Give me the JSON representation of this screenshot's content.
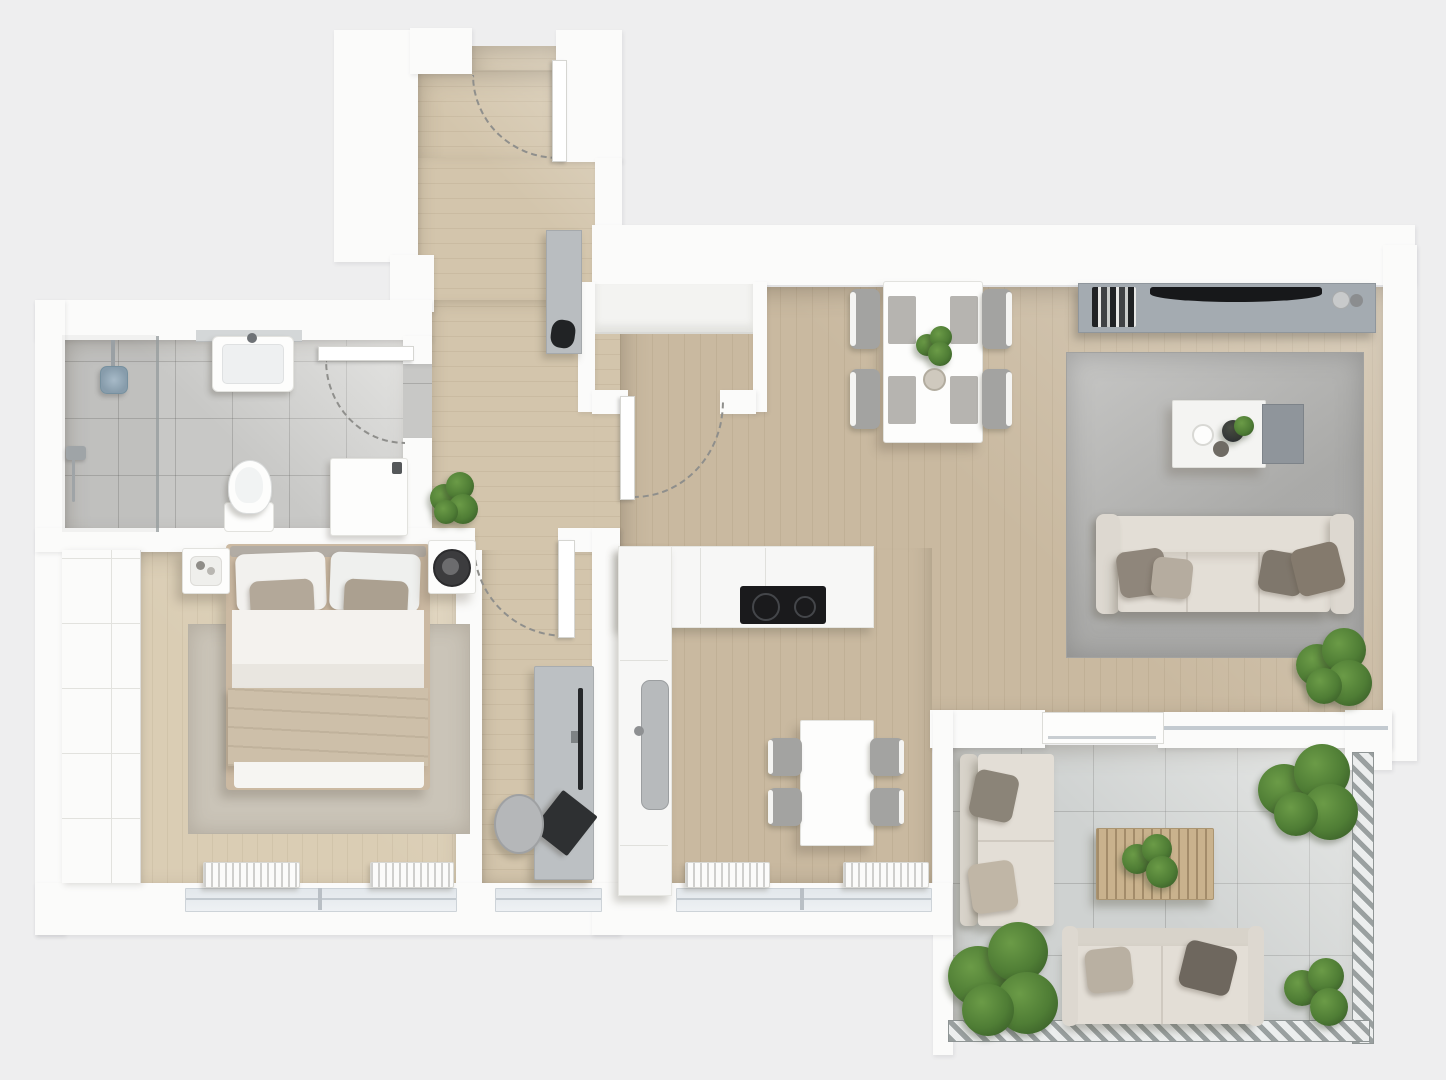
{
  "meta": {
    "title": "3D top-down floor plan of a one-bedroom apartment with balcony",
    "view": "top-down 3d render",
    "visible_text": ""
  },
  "palette": {
    "bg": "#eeeeef",
    "wall": "#fbfbfa",
    "wood-hall": "#d3c5ac",
    "wood-living": "#c9b9a0",
    "wood-bedroom": "#dacdb4",
    "tile-bath": "#c8c8c6",
    "tile-balcony": "#cfd2d1",
    "rug-living": "#b4b4b2",
    "rug-bedroom": "#cac4b8",
    "sofa": "#e3ded6",
    "console": "#a4abb1",
    "tv": "#17181a",
    "counter": "#f7f7f6",
    "appliance": "#1a1a1c",
    "chair": "#a3a3a1",
    "plant-dark": "#3b6029",
    "plant-mid": "#4f7d35",
    "plant-light": "#6b9b47",
    "outdoor-wood": "#c9b28d",
    "arc": "#8f8f8c",
    "sink-gray": "#b7babc",
    "desk-gray": "#bcc0c3",
    "blanket": "#cdbfa9",
    "pillow-taupe": "#b3a899",
    "cushion-dark": "#847a6d",
    "railing-dark": "#9aa0a0",
    "railing-light": "#eceeee"
  },
  "rooms": [
    {
      "name": "entry-hall",
      "floor": "wood",
      "items": [
        "front-door with swing arc",
        "gray sideboard with dark decor"
      ]
    },
    {
      "name": "hall-closet",
      "floor": "wood",
      "items": [
        "recessed wardrobe shelf",
        "closet door with swing arc"
      ]
    },
    {
      "name": "hallway",
      "floor": "wood",
      "items": [
        "potted plant",
        "desk",
        "monitor",
        "laptop",
        "stool",
        "door to bedroom nook"
      ]
    },
    {
      "name": "bathroom",
      "floor": "gray tile",
      "items": [
        "walk-in shower with glass screen",
        "shower head",
        "wall faucet",
        "washbasin",
        "toilet",
        "washer cabinet",
        "door with swing arc"
      ]
    },
    {
      "name": "bedroom",
      "floor": "wood",
      "items": [
        "double bed with pillows and beige blanket",
        "area rug",
        "left nightstand with tray",
        "right nightstand with dark round tray",
        "tall wardrobe",
        "two radiators",
        "window band"
      ]
    },
    {
      "name": "kitchen",
      "floor": "wood",
      "items": [
        "L-shaped counter",
        "black cooktop",
        "gray sink",
        "table for four",
        "four gray chairs",
        "two radiators",
        "window band"
      ]
    },
    {
      "name": "living-room",
      "floor": "wood",
      "items": [
        "media sideboard",
        "flat tv",
        "books",
        "decor objects",
        "dining table for four",
        "four gray chairs",
        "plant on table",
        "bowl",
        "large gray rug",
        "two-tone coffee table",
        "vase and cups",
        "three-seat sofa with four cushions",
        "floor plant",
        "sliding balcony door"
      ]
    },
    {
      "name": "balcony",
      "floor": "light tile",
      "items": [
        "vertical outdoor sofa with two cushions",
        "horizontal outdoor sofa with two cushions",
        "slatted wooden coffee table with plant",
        "three potted plants",
        "hatched railing right and bottom"
      ]
    }
  ]
}
